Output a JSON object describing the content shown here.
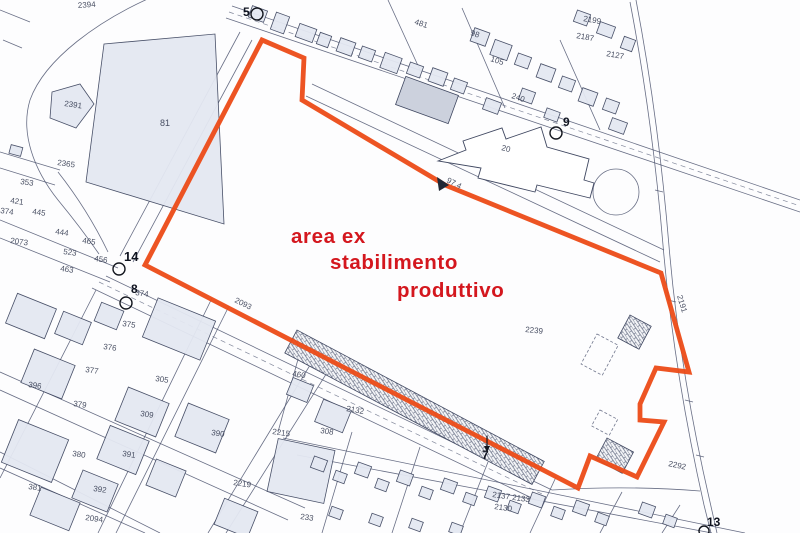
{
  "annotation": {
    "line1": "area ex",
    "line2": "stabilimento",
    "line3": "produttivo",
    "color": "#d4171e"
  },
  "colors": {
    "boundary_outline": "#ec4b17",
    "linework": "#4d5570",
    "building_fill": "#e4e8f2",
    "paper": "#fdfdfe"
  },
  "map": {
    "labels": [
      {
        "text": "2394",
        "x": 78,
        "y": 8,
        "rot": -4
      },
      {
        "text": "2391",
        "x": 64,
        "y": 106,
        "rot": 8
      },
      {
        "text": "81",
        "x": 160,
        "y": 126,
        "size": 9
      },
      {
        "text": "2365",
        "x": 57,
        "y": 165,
        "rot": 8
      },
      {
        "text": "353",
        "x": 20,
        "y": 184,
        "rot": 8
      },
      {
        "text": "421",
        "x": 10,
        "y": 203,
        "rot": 8
      },
      {
        "text": "374",
        "x": 0,
        "y": 213,
        "rot": 8
      },
      {
        "text": "445",
        "x": 32,
        "y": 214,
        "rot": 8
      },
      {
        "text": "444",
        "x": 55,
        "y": 234,
        "rot": 8
      },
      {
        "text": "465",
        "x": 82,
        "y": 243,
        "rot": 8
      },
      {
        "text": "2073",
        "x": 10,
        "y": 243,
        "rot": 8
      },
      {
        "text": "523",
        "x": 63,
        "y": 254,
        "rot": 8
      },
      {
        "text": "463",
        "x": 60,
        "y": 271,
        "rot": 8
      },
      {
        "text": "456",
        "x": 94,
        "y": 261,
        "rot": 8
      },
      {
        "text": "481",
        "x": 414,
        "y": 24,
        "rot": 18
      },
      {
        "text": "98",
        "x": 470,
        "y": 35,
        "rot": 18
      },
      {
        "text": "105",
        "x": 490,
        "y": 61,
        "rot": 18
      },
      {
        "text": "240",
        "x": 511,
        "y": 98,
        "rot": 18
      },
      {
        "text": "2199",
        "x": 583,
        "y": 21,
        "rot": 10
      },
      {
        "text": "2187",
        "x": 576,
        "y": 38,
        "rot": 10
      },
      {
        "text": "2127",
        "x": 606,
        "y": 56,
        "rot": 10
      },
      {
        "text": "20",
        "x": 501,
        "y": 150,
        "rot": 14
      },
      {
        "text": "97.4",
        "x": 446,
        "y": 182,
        "rot": 27
      },
      {
        "text": "2093",
        "x": 234,
        "y": 302,
        "rot": 26
      },
      {
        "text": "2239",
        "x": 525,
        "y": 332,
        "rot": 6
      },
      {
        "text": "2191",
        "x": 677,
        "y": 296,
        "rot": 73
      },
      {
        "text": "2292",
        "x": 668,
        "y": 466,
        "rot": 12
      },
      {
        "text": "396",
        "x": 28,
        "y": 387,
        "rot": 8
      },
      {
        "text": "377",
        "x": 85,
        "y": 372,
        "rot": 8
      },
      {
        "text": "375",
        "x": 122,
        "y": 326,
        "rot": 8
      },
      {
        "text": "376",
        "x": 103,
        "y": 349,
        "rot": 8
      },
      {
        "text": "374",
        "x": 135,
        "y": 295,
        "rot": 8
      },
      {
        "text": "305",
        "x": 155,
        "y": 381,
        "rot": 8
      },
      {
        "text": "379",
        "x": 73,
        "y": 406,
        "rot": 8
      },
      {
        "text": "309",
        "x": 140,
        "y": 416,
        "rot": 8
      },
      {
        "text": "390",
        "x": 211,
        "y": 435,
        "rot": 8
      },
      {
        "text": "391",
        "x": 122,
        "y": 456,
        "rot": 8
      },
      {
        "text": "380",
        "x": 72,
        "y": 456,
        "rot": 8
      },
      {
        "text": "381",
        "x": 28,
        "y": 489,
        "rot": 8
      },
      {
        "text": "392",
        "x": 93,
        "y": 491,
        "rot": 8
      },
      {
        "text": "2094",
        "x": 85,
        "y": 520,
        "rot": 8
      },
      {
        "text": "233",
        "x": 300,
        "y": 519,
        "rot": 8
      },
      {
        "text": "2219",
        "x": 233,
        "y": 485,
        "rot": 8
      },
      {
        "text": "2215",
        "x": 272,
        "y": 434,
        "rot": 8
      },
      {
        "text": "308",
        "x": 320,
        "y": 433,
        "rot": 8
      },
      {
        "text": "2132",
        "x": 346,
        "y": 411,
        "rot": 10
      },
      {
        "text": "460",
        "x": 292,
        "y": 376,
        "rot": 10
      },
      {
        "text": "2137 2133",
        "x": 492,
        "y": 497,
        "rot": 8
      },
      {
        "text": "2130",
        "x": 494,
        "y": 509,
        "rot": 8
      }
    ],
    "markers": [
      {
        "text": "5",
        "x": 243,
        "y": 16,
        "cx": 257,
        "cy": 14,
        "r": 6
      },
      {
        "text": "9",
        "x": 563,
        "y": 126,
        "cx": 556,
        "cy": 133,
        "r": 6
      },
      {
        "text": "14",
        "x": 124,
        "y": 261,
        "cx": 119,
        "cy": 269,
        "r": 6,
        "size": 13
      },
      {
        "text": "8",
        "x": 131,
        "y": 293,
        "cx": 126,
        "cy": 303,
        "r": 6
      },
      {
        "text": "7",
        "x": 482,
        "y": 459
      },
      {
        "text": "13",
        "x": 707,
        "y": 526,
        "cx": 704,
        "cy": 531,
        "r": 5
      }
    ]
  }
}
